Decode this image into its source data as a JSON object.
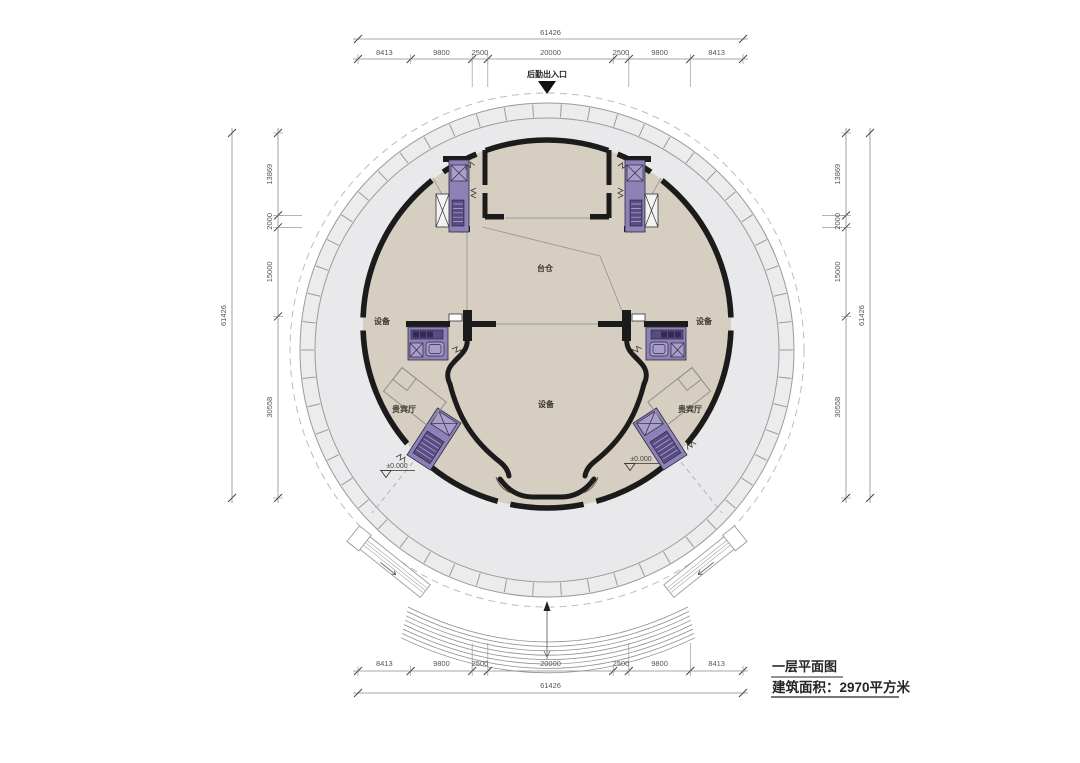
{
  "title_block": {
    "plan_title": "一层平面图",
    "area_line": "建筑面积：2970平方米"
  },
  "entrance_label": "后勤出入口",
  "labels": {
    "stage_pit": "台仓",
    "equipment_left": "设备",
    "equipment_right": "设备",
    "equipment_bottom": "设备",
    "vip_left": "贵宾厅",
    "vip_right": "贵宾厅",
    "level_left": "±0.000",
    "level_right": "±0.000"
  },
  "dimensions": {
    "total": "61426",
    "horizontal_segments": [
      "8413",
      "9800",
      "2500",
      "20000",
      "2500",
      "9800",
      "8413"
    ],
    "vertical_segments": [
      "13869",
      "2000",
      "15000",
      "30558"
    ]
  },
  "colors": {
    "plaza": "#e9e8ea",
    "ring_band": "#ecebed",
    "building": "#d6cec1",
    "wall": "#1b1b1b",
    "core_purple": "#8d82b7",
    "core_purple_dark": "#584c83",
    "core_purple_deep": "#332b55",
    "dim_line": "#8a8a8a",
    "dim_text": "#555555",
    "thin_line": "#9a9a9a"
  }
}
